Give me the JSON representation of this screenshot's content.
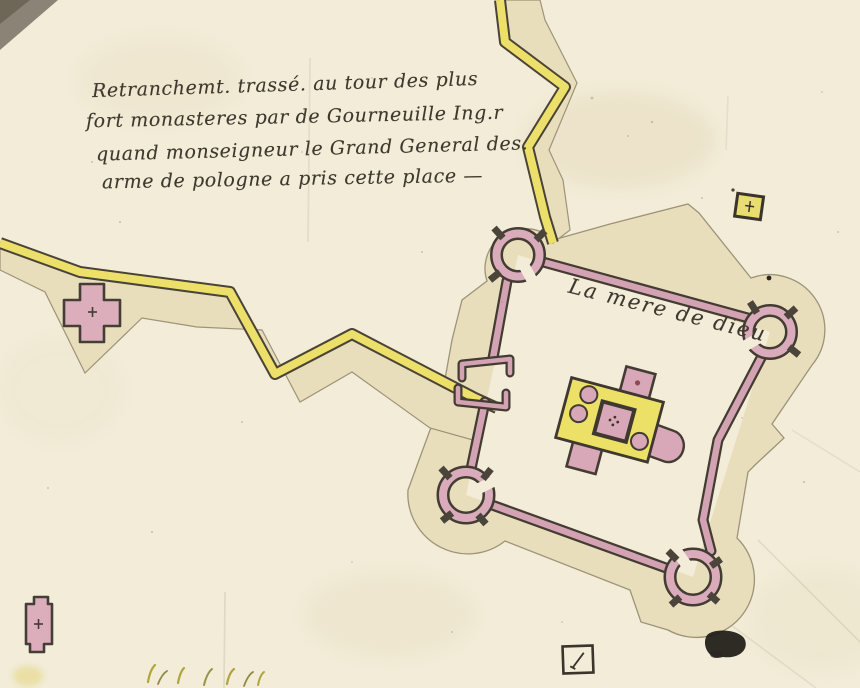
{
  "document": {
    "type": "manuscript fortification map",
    "annotation": {
      "lines": [
        "Retranchemt. trassé. au tour des plus",
        "fort monasteres par de Gourneuille Ing.r",
        "quand monseigneur le Grand General des.",
        "arme de pologne a pris cette place —"
      ]
    },
    "labels": {
      "fort": "La mere de dieu"
    },
    "colors": {
      "paper": "#f2ecd8",
      "glacis_tan": "#e9debb",
      "rampart_yellow": "#ece06b",
      "wall_pink": "#d4a3b3",
      "building_yellow": "#ece066",
      "ink_dark": "#433c33",
      "ink_text": "#3e382e"
    }
  }
}
